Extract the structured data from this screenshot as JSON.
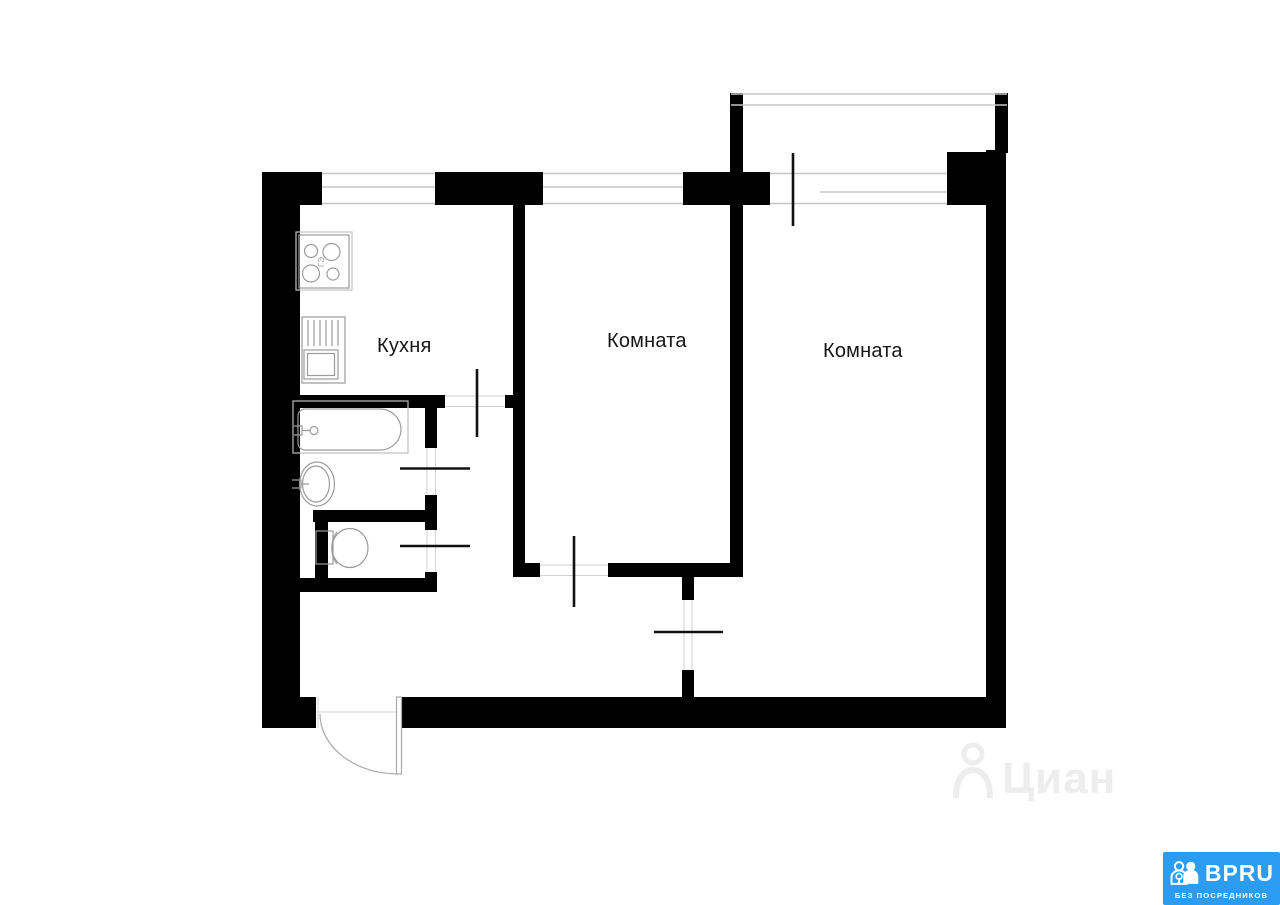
{
  "floor_plan": {
    "rooms": [
      {
        "name": "kitchen",
        "label": "Кухня"
      },
      {
        "name": "room-small",
        "label": "Комната"
      },
      {
        "name": "room-large",
        "label": "Комната"
      }
    ],
    "stove_marking": "ГЭ",
    "fixtures": [
      "stove-icon",
      "kitchen-sink-icon",
      "bathtub-icon",
      "washbasin-icon",
      "toilet-icon"
    ],
    "colors": {
      "wall": "#000000",
      "fixture_line": "#9b9b9b",
      "window_line": "#c6c6c6"
    }
  },
  "watermark": {
    "text": "Циан",
    "color": "#ededed",
    "icon": "map-pin-person-icon"
  },
  "logo": {
    "brand": "BPRU",
    "tagline": "БЕЗ ПОСРЕДНИКОВ",
    "background": "#2b9cf2",
    "text_color": "#ffffff",
    "icon": "people-key-icon"
  }
}
